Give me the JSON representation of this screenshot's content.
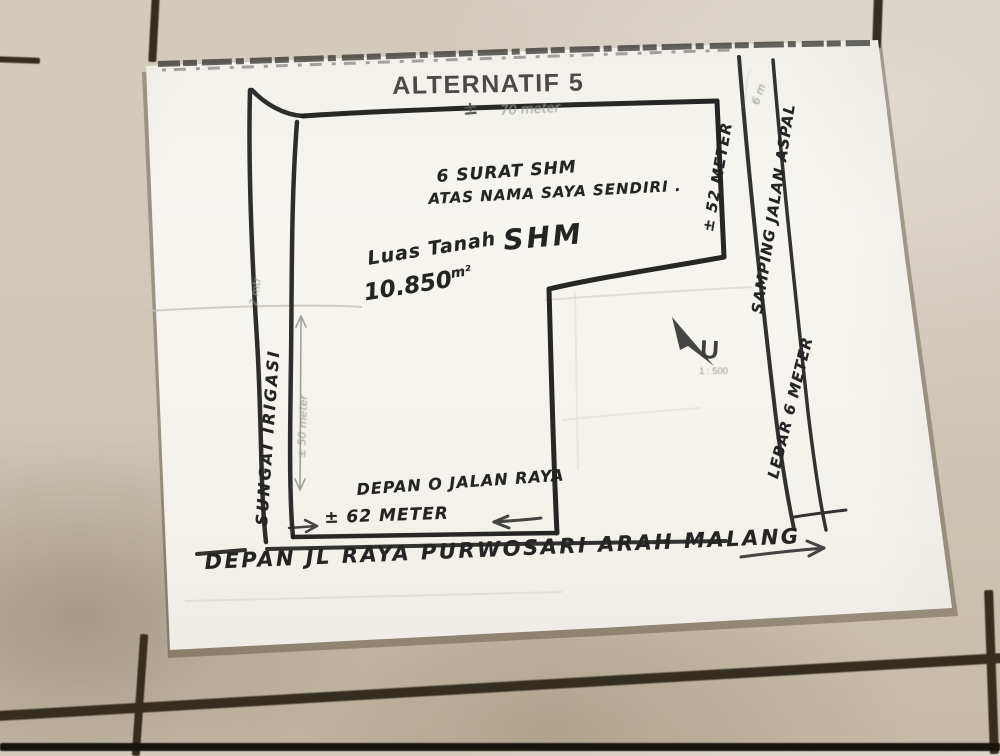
{
  "colors": {
    "floor": "#cfc6b6",
    "grout": "#352e1f",
    "paper": "#f5f3ee",
    "ink": "#242424",
    "pencil": "#94978f"
  },
  "sketch": {
    "title": "ALTERNATIF 5",
    "labels": {
      "top_width_sign": "±",
      "top_width": "70 meter",
      "certificate_line1": "6 SURAT SHM",
      "certificate_line2": "ATAS NAMA SAYA SENDIRI .",
      "land_area_label": "Luas Tanah",
      "certificate_type": "SHM",
      "land_area_value": "10.850",
      "land_area_unit": "m²",
      "right_boundary_length": "± 52 METER",
      "right_road_name": "SAMPING JALAN ASPAL",
      "right_road_width": "LEBAR 6 METER",
      "right_road_pencil_note": "6 m",
      "canal_name": "SUNGAI IRIGASI",
      "canal_pencil_note": "2 mtr",
      "left_boundary_length": "± 50 meter",
      "north_letter": "U",
      "scale_note": "1 : 500",
      "front_label": "DEPAN O JALAN RAYA",
      "front_width": "± 62 METER",
      "bottom_road_label": "DEPAN JL RAYA PURWOSARI ARAH MALANG"
    }
  }
}
